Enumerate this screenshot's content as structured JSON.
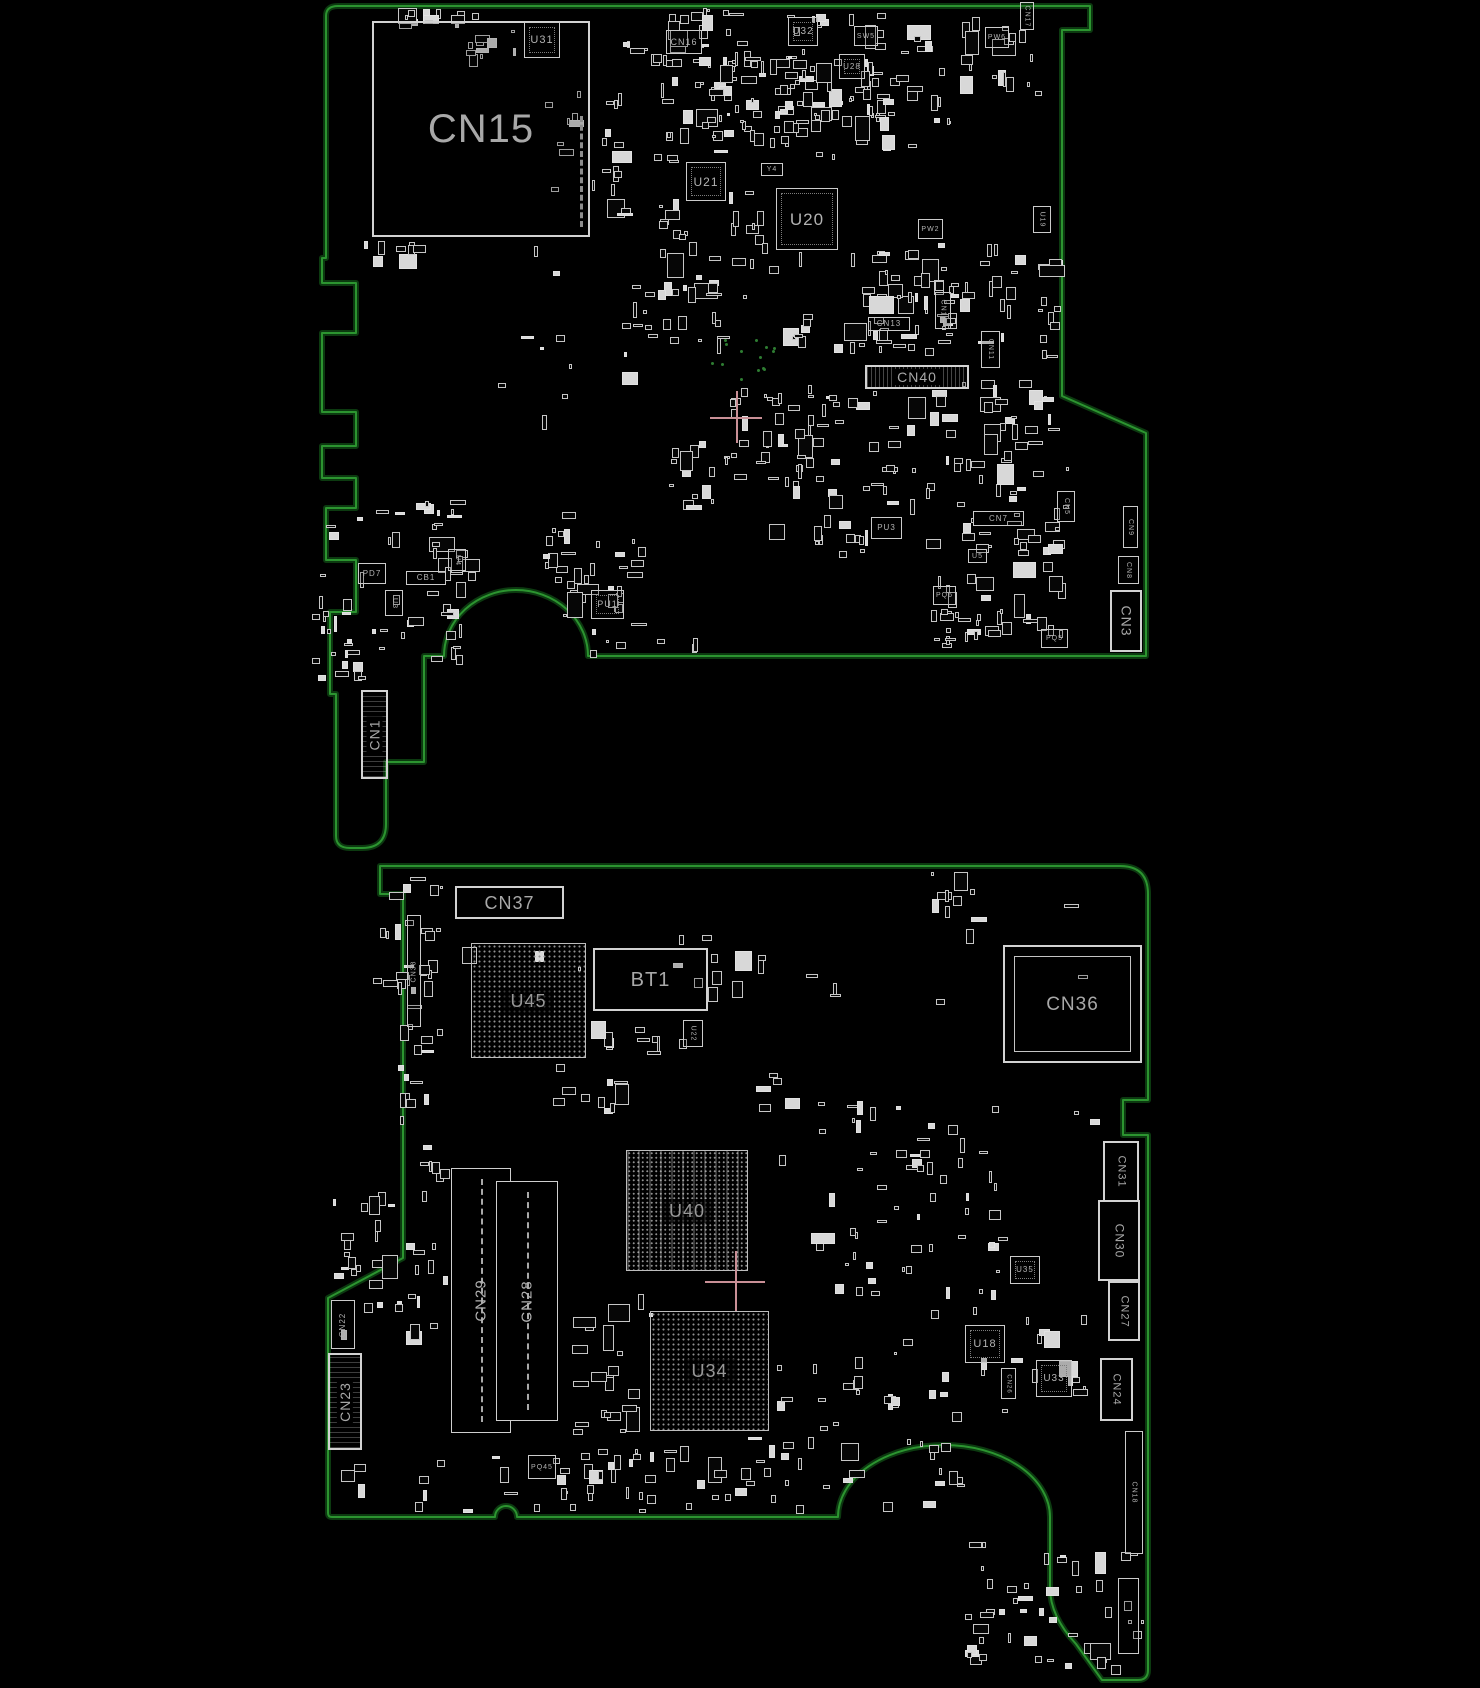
{
  "meta": {
    "width": 1480,
    "height": 1688,
    "background": "#000000",
    "diagram_kind": "pcb-boardview"
  },
  "colors": {
    "outline": "#2c9430",
    "outline_glow": "#0c3a10",
    "component_stroke": "#cbcbcb",
    "label": "#b2b2b2",
    "bga_label": "#979797",
    "crosshair": "#c98f96",
    "via": "#2e7d32"
  },
  "boards": [
    {
      "id": "top",
      "components": [
        {
          "label": "CN15",
          "x": 372,
          "y": 21,
          "w": 218,
          "h": 216,
          "type": "conn",
          "fs": 40,
          "variant": "ticks-right"
        },
        {
          "label": "U31",
          "x": 524,
          "y": 22,
          "w": 36,
          "h": 36,
          "type": "ic",
          "fs": 11
        },
        {
          "label": "CN16",
          "x": 666,
          "y": 30,
          "w": 36,
          "h": 24,
          "type": "box",
          "fs": 9
        },
        {
          "label": "U32",
          "x": 788,
          "y": 17,
          "w": 30,
          "h": 29,
          "type": "ic",
          "fs": 10
        },
        {
          "label": "SW5",
          "x": 854,
          "y": 26,
          "w": 24,
          "h": 20,
          "type": "box",
          "fs": 7
        },
        {
          "label": "U28",
          "x": 839,
          "y": 54,
          "w": 26,
          "h": 25,
          "type": "ic",
          "fs": 8
        },
        {
          "label": "PW6",
          "x": 985,
          "y": 27,
          "w": 24,
          "h": 21,
          "type": "box",
          "fs": 7
        },
        {
          "label": "CN17",
          "x": 1020,
          "y": 2,
          "w": 14,
          "h": 28,
          "type": "box",
          "fs": 7,
          "rot": 90
        },
        {
          "label": "U21",
          "x": 686,
          "y": 162,
          "w": 40,
          "h": 39,
          "type": "ic",
          "fs": 12
        },
        {
          "label": "Y4",
          "x": 761,
          "y": 163,
          "w": 22,
          "h": 13,
          "type": "box",
          "fs": 7
        },
        {
          "label": "U20",
          "x": 776,
          "y": 188,
          "w": 62,
          "h": 62,
          "type": "ic",
          "fs": 17
        },
        {
          "label": "PW2",
          "x": 918,
          "y": 219,
          "w": 25,
          "h": 20,
          "type": "box",
          "fs": 7
        },
        {
          "label": "U19",
          "x": 1033,
          "y": 206,
          "w": 18,
          "h": 27,
          "type": "box",
          "fs": 7,
          "rot": 90
        },
        {
          "label": "CN13",
          "x": 868,
          "y": 317,
          "w": 42,
          "h": 14,
          "type": "box",
          "fs": 8
        },
        {
          "label": "CN12",
          "x": 935,
          "y": 292,
          "w": 16,
          "h": 37,
          "type": "box",
          "fs": 7,
          "rot": 90
        },
        {
          "label": "CN11",
          "x": 981,
          "y": 331,
          "w": 19,
          "h": 37,
          "type": "box",
          "fs": 7,
          "rot": 90
        },
        {
          "label": "CN40",
          "x": 865,
          "y": 365,
          "w": 104,
          "h": 24,
          "type": "conn",
          "fs": 14,
          "variant": "v-hatch"
        },
        {
          "label": "PU3",
          "x": 871,
          "y": 517,
          "w": 31,
          "h": 22,
          "type": "box",
          "fs": 8
        },
        {
          "label": "U5",
          "x": 968,
          "y": 549,
          "w": 19,
          "h": 14,
          "type": "box",
          "fs": 7
        },
        {
          "label": "CN7",
          "x": 973,
          "y": 511,
          "w": 51,
          "h": 15,
          "type": "box",
          "fs": 8
        },
        {
          "label": "CN5",
          "x": 1057,
          "y": 491,
          "w": 18,
          "h": 31,
          "type": "box",
          "fs": 7,
          "rot": 90
        },
        {
          "label": "CN9",
          "x": 1123,
          "y": 506,
          "w": 15,
          "h": 42,
          "type": "box",
          "fs": 7,
          "rot": 90
        },
        {
          "label": "CN8",
          "x": 1118,
          "y": 556,
          "w": 21,
          "h": 28,
          "type": "box",
          "fs": 7,
          "rot": 90
        },
        {
          "label": "CN3",
          "x": 1110,
          "y": 590,
          "w": 32,
          "h": 62,
          "type": "conn",
          "fs": 14,
          "rot": 90
        },
        {
          "label": "PQ6",
          "x": 933,
          "y": 586,
          "w": 23,
          "h": 19,
          "type": "box",
          "fs": 7
        },
        {
          "label": "PQ5",
          "x": 1041,
          "y": 629,
          "w": 27,
          "h": 19,
          "type": "box",
          "fs": 7
        },
        {
          "label": "PD7",
          "x": 358,
          "y": 563,
          "w": 28,
          "h": 21,
          "type": "box",
          "fs": 8
        },
        {
          "label": "CB1",
          "x": 406,
          "y": 571,
          "w": 40,
          "h": 14,
          "type": "box",
          "fs": 8
        },
        {
          "label": "U4",
          "x": 448,
          "y": 549,
          "w": 18,
          "h": 22,
          "type": "box",
          "fs": 7,
          "rot": 90
        },
        {
          "label": "U3",
          "x": 385,
          "y": 590,
          "w": 18,
          "h": 26,
          "type": "box",
          "fs": 7,
          "rot": 90
        },
        {
          "label": "PU1",
          "x": 591,
          "y": 590,
          "w": 33,
          "h": 29,
          "type": "ic",
          "fs": 9
        },
        {
          "label": "CN1",
          "x": 361,
          "y": 690,
          "w": 27,
          "h": 89,
          "type": "conn",
          "fs": 14,
          "rot": -90,
          "variant": "h-hatch"
        }
      ],
      "crosshairs": [
        {
          "x": 736,
          "y": 417,
          "arm": 26
        }
      ],
      "clusters": [
        [
          362,
          8,
          120,
          24,
          14
        ],
        [
          455,
          28,
          90,
          40,
          10
        ],
        [
          545,
          85,
          80,
          120,
          16
        ],
        [
          610,
          8,
          100,
          60,
          18
        ],
        [
          655,
          55,
          120,
          100,
          30
        ],
        [
          700,
          8,
          210,
          150,
          70
        ],
        [
          770,
          55,
          150,
          110,
          40
        ],
        [
          905,
          8,
          160,
          120,
          30
        ],
        [
          600,
          150,
          90,
          90,
          18
        ],
        [
          640,
          190,
          140,
          110,
          25
        ],
        [
          780,
          250,
          180,
          110,
          35
        ],
        [
          620,
          285,
          120,
          75,
          20
        ],
        [
          855,
          270,
          120,
          90,
          25
        ],
        [
          930,
          240,
          130,
          110,
          22
        ],
        [
          695,
          380,
          120,
          120,
          28
        ],
        [
          760,
          390,
          160,
          170,
          45
        ],
        [
          880,
          380,
          180,
          180,
          55
        ],
        [
          1000,
          390,
          70,
          170,
          20
        ],
        [
          930,
          560,
          140,
          90,
          25
        ],
        [
          320,
          500,
          150,
          170,
          45
        ],
        [
          540,
          505,
          110,
          100,
          22
        ],
        [
          312,
          595,
          55,
          95,
          14
        ],
        [
          420,
          540,
          60,
          60,
          8
        ],
        [
          560,
          560,
          70,
          60,
          10
        ],
        [
          1040,
          255,
          25,
          105,
          10
        ],
        [
          360,
          240,
          200,
          40,
          10
        ],
        [
          480,
          330,
          180,
          120,
          8
        ],
        [
          660,
          440,
          60,
          80,
          10
        ],
        [
          580,
          620,
          120,
          40,
          8
        ],
        [
          940,
          600,
          90,
          50,
          12
        ]
      ],
      "via_clusters": [
        [
          705,
          338,
          75,
          40,
          14
        ]
      ]
    },
    {
      "id": "bottom",
      "components": [
        {
          "label": "CN37",
          "x": 455,
          "y": 886,
          "w": 109,
          "h": 33,
          "type": "conn",
          "fs": 18
        },
        {
          "label": "CN38",
          "x": 407,
          "y": 915,
          "w": 14,
          "h": 112,
          "type": "box",
          "fs": 7,
          "rot": -90
        },
        {
          "label": "U45",
          "x": 471,
          "y": 943,
          "w": 115,
          "h": 115,
          "type": "bga",
          "fs": 18
        },
        {
          "label": "BT1",
          "x": 593,
          "y": 948,
          "w": 115,
          "h": 63,
          "type": "conn",
          "fs": 20
        },
        {
          "label": "U22",
          "x": 683,
          "y": 1020,
          "w": 20,
          "h": 27,
          "type": "box",
          "fs": 7,
          "rot": 90
        },
        {
          "label": "CN36",
          "x": 1003,
          "y": 945,
          "w": 139,
          "h": 118,
          "type": "conn",
          "fs": 19,
          "variant": "double"
        },
        {
          "label": "U40",
          "x": 626,
          "y": 1150,
          "w": 122,
          "h": 121,
          "type": "bga",
          "fs": 18,
          "variant": "bga-alt"
        },
        {
          "label": "CN31",
          "x": 1103,
          "y": 1141,
          "w": 36,
          "h": 61,
          "type": "conn",
          "fs": 11,
          "rot": 90
        },
        {
          "label": "CN30",
          "x": 1098,
          "y": 1200,
          "w": 42,
          "h": 81,
          "type": "conn",
          "fs": 12,
          "rot": 90
        },
        {
          "label": "CN27",
          "x": 1108,
          "y": 1281,
          "w": 32,
          "h": 60,
          "type": "conn",
          "fs": 11,
          "rot": 90
        },
        {
          "label": "U35",
          "x": 1010,
          "y": 1256,
          "w": 30,
          "h": 28,
          "type": "ic",
          "fs": 8
        },
        {
          "label": "CN29",
          "x": 451,
          "y": 1168,
          "w": 60,
          "h": 265,
          "type": "slot",
          "fs": 15,
          "rot": -90
        },
        {
          "label": "CN28",
          "x": 496,
          "y": 1181,
          "w": 62,
          "h": 240,
          "type": "slot",
          "fs": 15,
          "rot": -90
        },
        {
          "label": "CN22",
          "x": 331,
          "y": 1300,
          "w": 24,
          "h": 49,
          "type": "box",
          "fs": 8,
          "rot": -90
        },
        {
          "label": "CN23",
          "x": 328,
          "y": 1353,
          "w": 34,
          "h": 97,
          "type": "conn",
          "fs": 14,
          "rot": -90,
          "variant": "h-hatch"
        },
        {
          "label": "U34",
          "x": 650,
          "y": 1311,
          "w": 119,
          "h": 120,
          "type": "bga",
          "fs": 18
        },
        {
          "label": "U18",
          "x": 965,
          "y": 1325,
          "w": 40,
          "h": 38,
          "type": "ic",
          "fs": 11
        },
        {
          "label": "U33",
          "x": 1036,
          "y": 1360,
          "w": 36,
          "h": 37,
          "type": "ic",
          "fs": 10
        },
        {
          "label": "CN26",
          "x": 1001,
          "y": 1368,
          "w": 15,
          "h": 31,
          "type": "box",
          "fs": 6,
          "rot": 90
        },
        {
          "label": "CN24",
          "x": 1100,
          "y": 1358,
          "w": 33,
          "h": 63,
          "type": "conn",
          "fs": 11,
          "rot": 90
        },
        {
          "label": "CN18",
          "x": 1125,
          "y": 1431,
          "w": 18,
          "h": 123,
          "type": "box",
          "fs": 7,
          "rot": 90
        },
        {
          "label": "PQ45",
          "x": 528,
          "y": 1455,
          "w": 28,
          "h": 24,
          "type": "box",
          "fs": 7
        },
        {
          "label": "",
          "x": 1118,
          "y": 1578,
          "w": 21,
          "h": 76,
          "type": "box",
          "fs": 7,
          "rot": 90
        }
      ],
      "crosshairs": [
        {
          "x": 735,
          "y": 1281,
          "arm": 30
        }
      ],
      "clusters": [
        [
          373,
          870,
          70,
          140,
          26
        ],
        [
          398,
          1020,
          50,
          120,
          14
        ],
        [
          540,
          1060,
          90,
          55,
          10
        ],
        [
          590,
          1015,
          110,
          45,
          10
        ],
        [
          755,
          1070,
          120,
          70,
          10
        ],
        [
          900,
          1150,
          110,
          170,
          30
        ],
        [
          330,
          1190,
          120,
          165,
          35
        ],
        [
          545,
          1435,
          420,
          80,
          65
        ],
        [
          960,
          1540,
          185,
          140,
          50
        ],
        [
          770,
          1150,
          130,
          150,
          18
        ],
        [
          600,
          1285,
          55,
          150,
          14
        ],
        [
          775,
          1320,
          190,
          115,
          22
        ],
        [
          430,
          900,
          660,
          110,
          16
        ],
        [
          850,
          1100,
          260,
          60,
          12
        ],
        [
          980,
          1300,
          120,
          120,
          15
        ],
        [
          340,
          1455,
          200,
          60,
          12
        ],
        [
          700,
          950,
          80,
          60,
          6
        ],
        [
          420,
          1140,
          30,
          60,
          6
        ],
        [
          560,
          1315,
          80,
          120,
          10
        ],
        [
          915,
          870,
          80,
          60,
          8
        ]
      ],
      "via_clusters": []
    }
  ]
}
